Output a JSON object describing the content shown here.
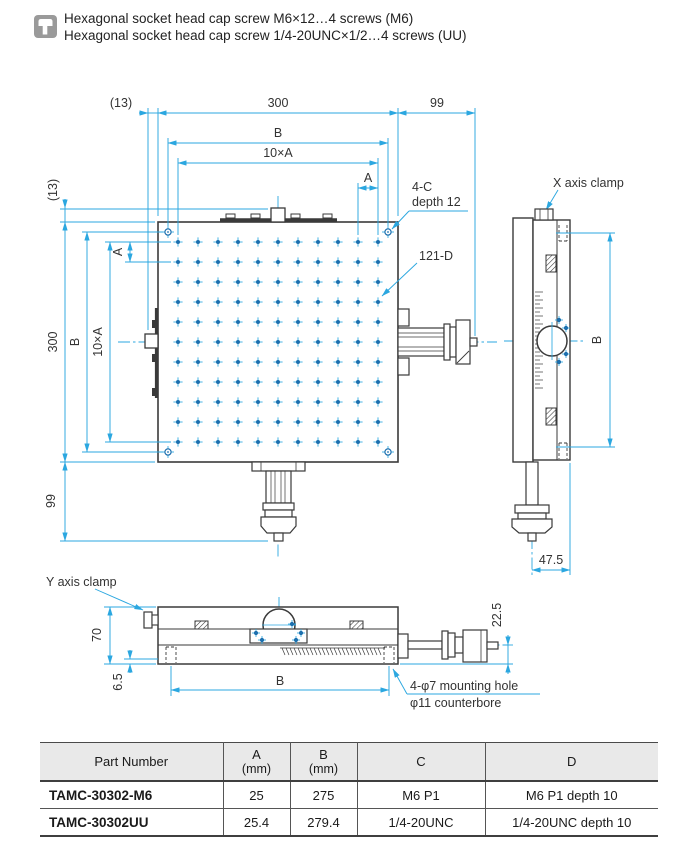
{
  "notes": {
    "line1": "Hexagonal socket head cap screw M6×12…4 screws (M6)",
    "line2": "Hexagonal socket head cap screw 1/4-20UNC×1/2…4 screws (UU)"
  },
  "colors": {
    "dimension_cyan": "#2BA7E0",
    "drawing_line": "#3a3a3a",
    "hole_blue": "#1c6fae",
    "table_header_bg": "#e9e9e9"
  },
  "top_view": {
    "dim_13_top": "(13)",
    "dim_300_top": "300",
    "dim_99_right": "99",
    "dim_B_top": "B",
    "dim_10xA_top": "10×A",
    "dim_A_top": "A",
    "dim_13_left": "(13)",
    "dim_300_left": "300",
    "dim_B_left": "B",
    "dim_10xA_left": "10×A",
    "dim_A_left": "A",
    "dim_99_left": "99",
    "label_corner_holes_1": "4-C",
    "label_corner_holes_2": "depth 12",
    "label_grid_holes": "121-D",
    "label_x_clamp": "X axis clamp"
  },
  "side_view": {
    "dim_B": "B",
    "dim_47_5": "47.5"
  },
  "front_view": {
    "label_y_clamp": "Y axis clamp",
    "dim_70": "70",
    "dim_6_5": "6.5",
    "dim_22_5": "22.5",
    "dim_B": "B",
    "label_mount_1": "4-φ7 mounting hole",
    "label_mount_2": "φ11 counterbore"
  },
  "table": {
    "headers": [
      {
        "label": "Part Number",
        "sub": ""
      },
      {
        "label": "A",
        "sub": "(mm)"
      },
      {
        "label": "B",
        "sub": "(mm)"
      },
      {
        "label": "C",
        "sub": ""
      },
      {
        "label": "D",
        "sub": ""
      }
    ],
    "rows": [
      {
        "part": "TAMC-30302-M6",
        "a": "25",
        "b": "275",
        "c": "M6 P1",
        "d": "M6 P1 depth 10"
      },
      {
        "part": "TAMC-30302UU",
        "a": "25.4",
        "b": "279.4",
        "c": "1/4-20UNC",
        "d": "1/4-20UNC depth 10"
      }
    ]
  }
}
